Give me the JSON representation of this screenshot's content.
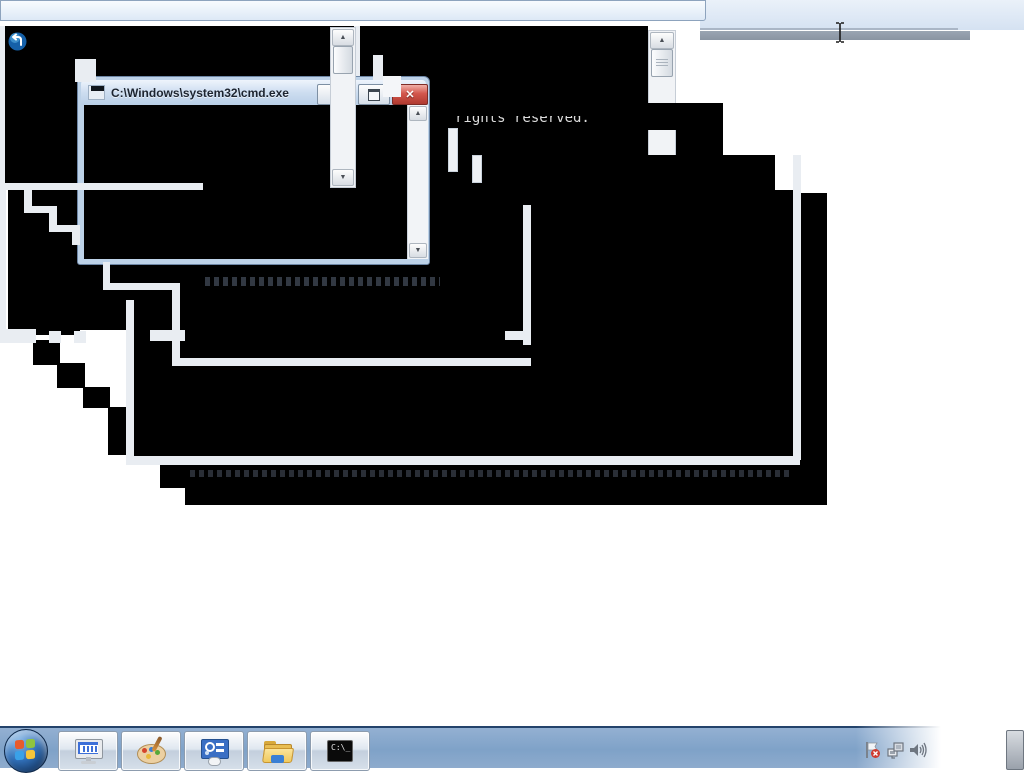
{
  "window": {
    "title": "C:\\Windows\\system32\\cmd.exe"
  },
  "console": {
    "rights_text": "rights reserved."
  },
  "glyphs": {
    "up_arrow": "▲",
    "down_arrow": "▼",
    "close": "✕"
  },
  "taskbar": {
    "cmd_icon_text": "C:\\_",
    "app_icons": [
      "on-screen-keyboard",
      "paint",
      "ease-of-access",
      "windows-explorer",
      "command-prompt"
    ],
    "tray_icons": [
      "action-center-flag",
      "network",
      "volume"
    ]
  },
  "colors": {
    "taskbar_blue": "#7fa2c8",
    "titlebar_blue": "#bed3ea",
    "close_red": "#c9504a",
    "console_black": "#000000",
    "topbar_blue": "#dfe9f6"
  }
}
